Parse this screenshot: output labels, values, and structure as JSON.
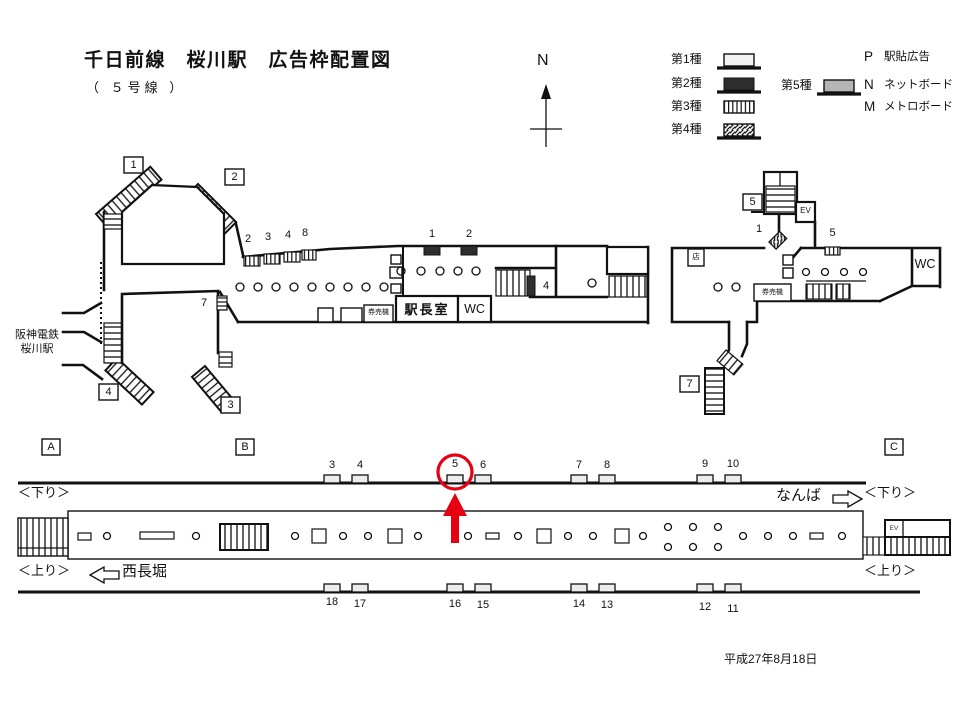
{
  "title": "千日前線　桜川駅　広告枠配置図",
  "subtitle": "（ ５号線 ）",
  "compass_n": "N",
  "legend": {
    "type1": "第1種",
    "type2": "第2種",
    "type3": "第3種",
    "type4": "第4種",
    "type5": "第5種",
    "p_key": "P",
    "p_label": "駅貼広告",
    "n_key": "N",
    "n_label": "ネットボード",
    "m_key": "M",
    "m_label": "メトロボード"
  },
  "concourse": {
    "hanshin_l1": "阪神電鉄",
    "hanshin_l2": "桜川駅",
    "exit1": "1",
    "exit2": "2",
    "exit3": "3",
    "exit4": "4",
    "exit5": "5",
    "exit7": "7",
    "ad_c2": "2",
    "ad_c3": "3",
    "ad_c4": "4",
    "ad_c8": "8",
    "ad_c7": "7",
    "ad_m1": "1",
    "ad_m2": "2",
    "ad_m4": "4",
    "ad_r1": "1",
    "ad_r5": "5",
    "stationmaster": "駅長室",
    "wc_left": "WC",
    "wc_right": "WC",
    "kenbaiki_left": "券売機",
    "kenbaiki_right": "券売機",
    "shop": "店",
    "ev": "EV"
  },
  "platform": {
    "section_a": "A",
    "section_b": "B",
    "section_c": "C",
    "down_left": "＜下り＞",
    "down_right": "＜下り＞",
    "up_left": "＜上り＞",
    "up_right": "＜上り＞",
    "namba": "なんば",
    "nishinagahori": "西長堀",
    "ev_room": "EV",
    "top_nums": [
      "3",
      "4",
      "5",
      "6",
      "7",
      "8",
      "9",
      "10"
    ],
    "bottom_nums": [
      "18",
      "17",
      "16",
      "15",
      "14",
      "13",
      "12",
      "11"
    ]
  },
  "date": "平成27年8月18日",
  "colors": {
    "line": "#111111",
    "highlight": "#e60012",
    "type2_fill": "#2e2e2e",
    "type5_fill": "#b5b5b5",
    "type1_fill": "#f2f2f2"
  }
}
